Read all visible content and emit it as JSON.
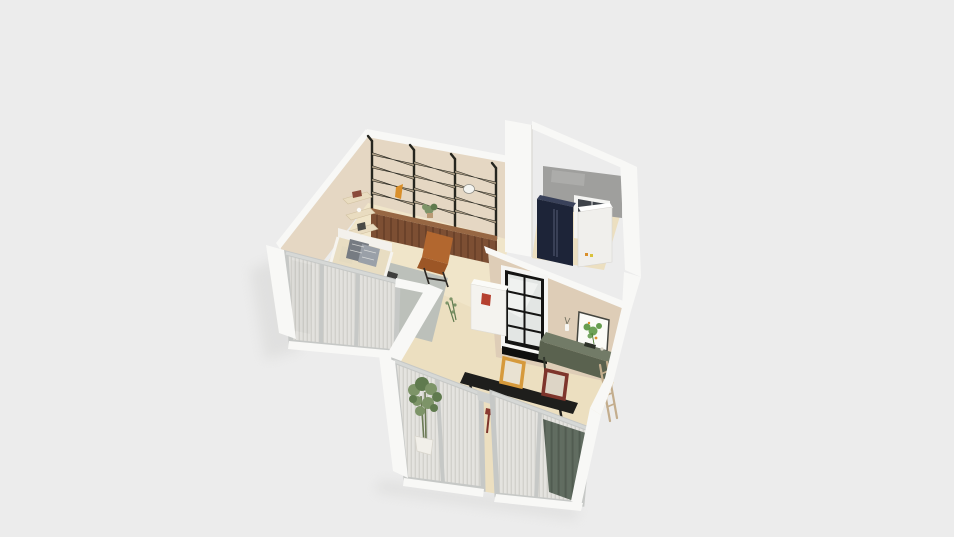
{
  "canvas": {
    "width": 954,
    "height": 537,
    "background": "#ececec"
  },
  "view": {
    "type": "3d-floorplan-render",
    "projection": "perspective-overhead"
  },
  "colors": {
    "bg": "#ececec",
    "shadow": "#cfcfcd",
    "wallWhite": "#f8f8f6",
    "wallWhiteShade": "#eceae7",
    "wallBeige": "#e5d7c3",
    "wallBeigeDark": "#decdb7",
    "floor": "#f0e5c9",
    "floorDark": "#ecdfc0",
    "grayWall": "#9f9f9d",
    "shelfFrame": "#26261f",
    "shelfWood": "#b5a58c",
    "cabinet": "#7d4f33",
    "cabinetTop": "#976743",
    "bedFrame": "#f3f1ec",
    "bedCream": "#e8ddc2",
    "duvet": "#b5bab2",
    "pillow": "#767b82",
    "rug": "#bcc0ba",
    "chair": "#b2672f",
    "chairDark": "#9c5626",
    "counter": "#f4f3ef",
    "kettle": "#b5402f",
    "navy": "#1d2438",
    "navyTop": "#39415a",
    "appliance": "#f0efec",
    "glassDark": "#3f444b",
    "windowFrame": "#c6c8c6",
    "glass": "#a6aba7",
    "curtain": "#edebe7",
    "curtainStripe": "#d8d6d1",
    "curtainGreen": "#5d695d",
    "curtainGreenDark": "#4d584d",
    "sideboard": "#5a624f",
    "sideboardTop": "#727b67",
    "artFrame": "#44453f",
    "artPaper": "#fbfbf7",
    "artGreen": "#55923c",
    "artOrange": "#d98f2b",
    "frameOrange": "#d69a3c",
    "frameRed": "#7e352c",
    "desk": "#1e1e1c",
    "ladder": "#c3ad8d",
    "plant": "#7d9468",
    "plantDark": "#5f7a4e",
    "pot": "#f1efe9"
  },
  "scene": {
    "rooms": [
      {
        "id": "living-bedroom",
        "walls": [
          "beige-left-wall",
          "beige-back-wall",
          "window-wall-front-left"
        ],
        "objects": [
          "black-metal-shelving-unit-3-bays",
          "wood-base-cabinets",
          "floating-wall-shelves",
          "bed-with-white-frame",
          "gray-rug",
          "cognac-lounge-chair",
          "shelf-decor-lamp",
          "shelf-decor-bird",
          "shelf-plant",
          "small-sprig-plant",
          "white-counter",
          "red-kettle"
        ]
      },
      {
        "id": "closet-utility",
        "walls": [
          "gray-concrete-back-wall",
          "white-walls"
        ],
        "objects": [
          "navy-wardrobe-fridge",
          "white-appliance",
          "dark-glass-door"
        ]
      },
      {
        "id": "kitchen-dining",
        "walls": [
          "beige-wall-with-art",
          "window-wall-left",
          "window-wall-right"
        ],
        "objects": [
          "black-grid-interior-window",
          "botanical-wall-art",
          "green-sideboard",
          "leaning-ladder",
          "picture-frame-orange",
          "picture-frame-red",
          "black-desk-table",
          "tall-potted-plant",
          "sheer-curtains",
          "green-curtain",
          "dining-chair-tan",
          "dining-chair-red"
        ]
      }
    ]
  }
}
